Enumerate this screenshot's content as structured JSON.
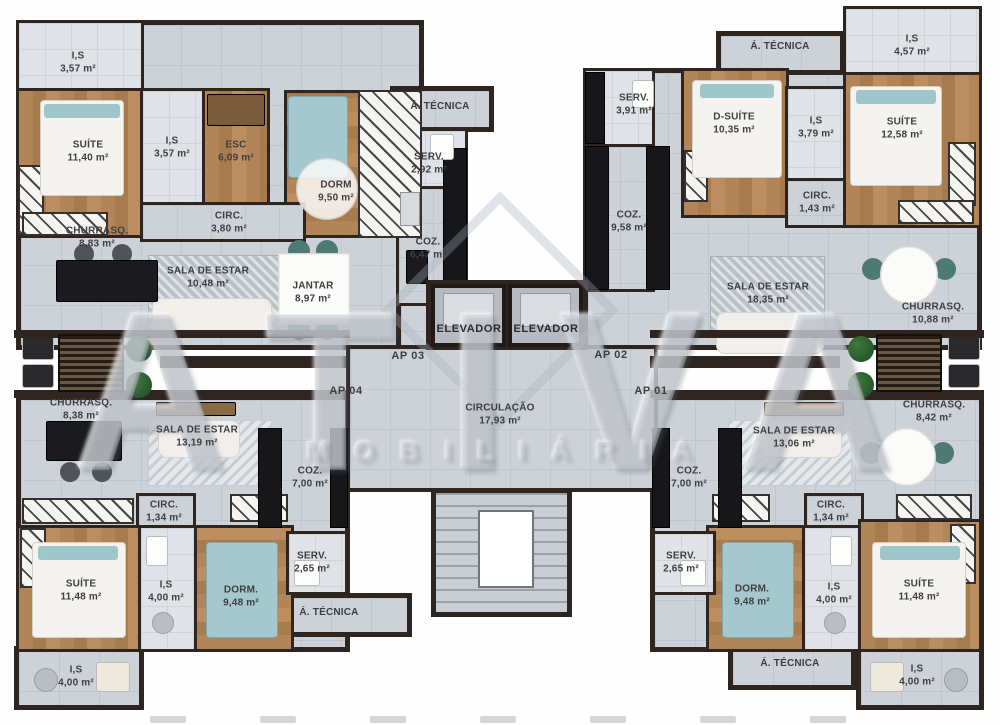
{
  "watermark": {
    "line1": "ATIVA",
    "line2": "MOBILIÁRIA"
  },
  "units": {
    "ap01": "AP 01",
    "ap02": "AP 02",
    "ap03": "AP 03",
    "ap04": "AP 04"
  },
  "core": {
    "elevator_left": "ELEVADOR",
    "elevator_right": "ELEVADOR",
    "circulation": {
      "label": "CIRCULAÇÃO",
      "area": "17,93 m²"
    }
  },
  "colors": {
    "wall": "#2e2420",
    "tile": "#cdd2d8",
    "wood": "#ab8254",
    "counter": "#17171a",
    "accent": "#9ec6cb"
  },
  "rooms": [
    {
      "id": "is-top-left",
      "label": "I,S",
      "area": "3,57 m²"
    },
    {
      "id": "suite-top-left",
      "label": "SUÍTE",
      "area": "11,40 m²"
    },
    {
      "id": "is-top-left-2",
      "label": "I,S",
      "area": "3,57 m²"
    },
    {
      "id": "esc",
      "label": "ESC",
      "area": "6,09 m²"
    },
    {
      "id": "dorm-top-left",
      "label": "DORM",
      "area": "9,50 m²"
    },
    {
      "id": "circ-top-left",
      "label": "CIRC.",
      "area": "3,80 m²"
    },
    {
      "id": "atec-top-left",
      "label": "Á. TÉCNICA",
      "area": ""
    },
    {
      "id": "serv-top-left",
      "label": "SERV.",
      "area": "2,92 m²"
    },
    {
      "id": "coz-top-left",
      "label": "COZ.",
      "area": "6,47 m²"
    },
    {
      "id": "jantar",
      "label": "JANTAR",
      "area": "8,97 m²"
    },
    {
      "id": "sala-top-left",
      "label": "SALA DE ESTAR",
      "area": "10,48 m²"
    },
    {
      "id": "churrasq-top-left",
      "label": "CHURRASQ.",
      "area": "8,83 m²"
    },
    {
      "id": "serv-top-right",
      "label": "SERV.",
      "area": "3,91 m²"
    },
    {
      "id": "coz-top-right",
      "label": "COZ.",
      "area": "9,58 m²"
    },
    {
      "id": "d-suite",
      "label": "D-SUÍTE",
      "area": "10,35 m²"
    },
    {
      "id": "atec-top-right",
      "label": "Á. TÉCNICA",
      "area": ""
    },
    {
      "id": "is-top-right",
      "label": "I,S",
      "area": "3,79 m²"
    },
    {
      "id": "is-top-right-2",
      "label": "I,S",
      "area": "4,57 m²"
    },
    {
      "id": "suite-top-right",
      "label": "SUÍTE",
      "area": "12,58 m²"
    },
    {
      "id": "circ-top-right",
      "label": "CIRC.",
      "area": "1,43 m²"
    },
    {
      "id": "sala-top-right",
      "label": "SALA DE ESTAR",
      "area": "18,35 m²"
    },
    {
      "id": "churrasq-top-right",
      "label": "CHURRASQ.",
      "area": "10,88 m²"
    },
    {
      "id": "churrasq-bot-left",
      "label": "CHURRASQ.",
      "area": "8,38 m²"
    },
    {
      "id": "sala-bot-left",
      "label": "SALA DE ESTAR",
      "area": "13,19 m²"
    },
    {
      "id": "coz-bot-left",
      "label": "COZ.",
      "area": "7,00 m²"
    },
    {
      "id": "serv-bot-left",
      "label": "SERV.",
      "area": "2,65 m²"
    },
    {
      "id": "atec-bot-left",
      "label": "Á. TÉCNICA",
      "area": ""
    },
    {
      "id": "circ-bot-left",
      "label": "CIRC.",
      "area": "1,34 m²"
    },
    {
      "id": "suite-bot-left",
      "label": "SUÍTE",
      "area": "11,48 m²"
    },
    {
      "id": "is-bot-left",
      "label": "I,S",
      "area": "4,00 m²"
    },
    {
      "id": "dorm-bot-left",
      "label": "DORM.",
      "area": "9,48 m²"
    },
    {
      "id": "is-bot-left-2",
      "label": "I,S",
      "area": "4,00 m²"
    },
    {
      "id": "churrasq-bot-right",
      "label": "CHURRASQ.",
      "area": "8,42 m²"
    },
    {
      "id": "sala-bot-right",
      "label": "SALA DE ESTAR",
      "area": "13,06 m²"
    },
    {
      "id": "coz-bot-right",
      "label": "COZ.",
      "area": "7,00 m²"
    },
    {
      "id": "serv-bot-right",
      "label": "SERV.",
      "area": "2,65 m²"
    },
    {
      "id": "dorm-bot-right",
      "label": "DORM.",
      "area": "9,48 m²"
    },
    {
      "id": "circ-bot-right",
      "label": "CIRC.",
      "area": "1,34 m²"
    },
    {
      "id": "is-bot-right",
      "label": "I,S",
      "area": "4,00 m²"
    },
    {
      "id": "suite-bot-right",
      "label": "SUÍTE",
      "area": "11,48 m²"
    },
    {
      "id": "atec-bot-right",
      "label": "Á. TÉCNICA",
      "area": ""
    },
    {
      "id": "is-bot-right-2",
      "label": "I,S",
      "area": "4,00 m²"
    }
  ]
}
